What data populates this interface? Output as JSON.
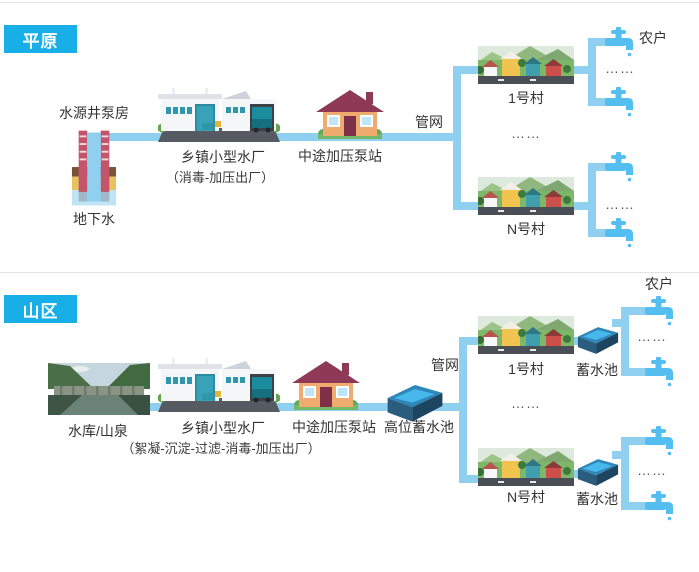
{
  "colors": {
    "badge_bg": "#18AFE8",
    "pipe_blue": "#8FD0F0",
    "faucet_blue": "#55BEF0",
    "pool_rim": "#2F86B8",
    "pool_water": "#47B7EC",
    "text": "#333333"
  },
  "icons": {
    "well_pump": "well-pump-icon (brick casing, water column, soil layers)",
    "water_plant": "water-plant-icon (white factory with truck)",
    "pump_station": "pump-house-icon (house with maroon roof)",
    "village": "village-icon (houses, hills, road)",
    "reservoir": "reservoir-photo-icon (dam between green mountains)",
    "storage_pool": "storage-pool-icon (isometric blue basin)",
    "faucet": "faucet-icon (tap with drip)"
  },
  "plain": {
    "badge": "平原",
    "well_label": "水源井泵房",
    "groundwater_label": "地下水",
    "plant_label": "乡镇小型水厂",
    "plant_process": "（消毒-加压出厂）",
    "pump_label": "中途加压泵站",
    "network_label": "管网",
    "village1_label": "1号村",
    "villageN_label": "N号村",
    "household_label": "农户",
    "dots": "……"
  },
  "mountain": {
    "badge": "山区",
    "source_label": "水库/山泉",
    "plant_label": "乡镇小型水厂",
    "plant_process": "（絮凝-沉淀-过滤-消毒-加压出厂）",
    "pump_label": "中途加压泵站",
    "high_tank_label": "高位蓄水池",
    "network_label": "管网",
    "village1_label": "1号村",
    "villageN_label": "N号村",
    "tank_label": "蓄水池",
    "household_label": "农户",
    "dots": "……"
  }
}
